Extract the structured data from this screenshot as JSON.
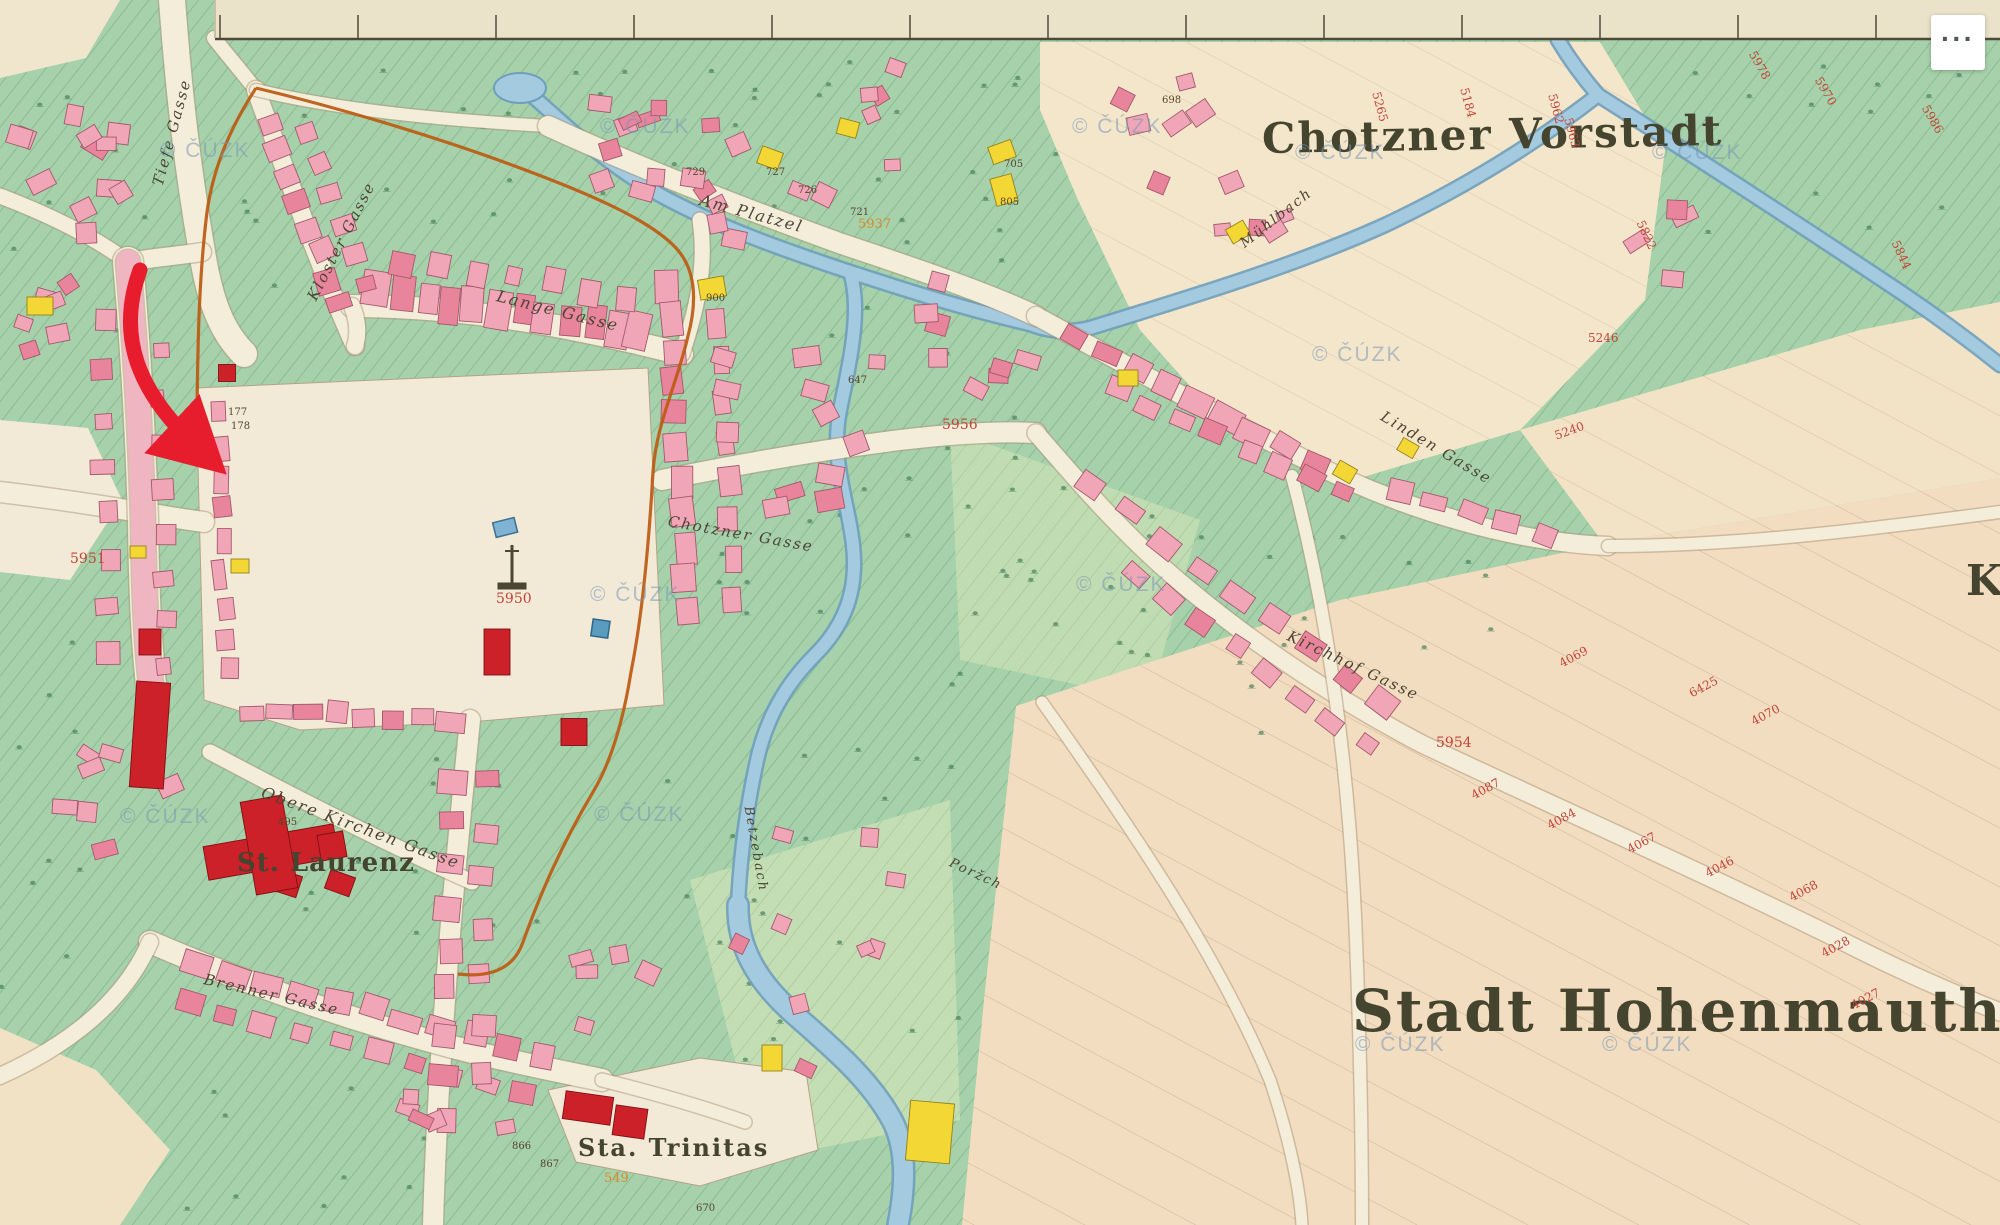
{
  "controls": {
    "more_button_label": "···"
  },
  "map": {
    "attribution_watermark": "© ČÚZK",
    "place_labels": [
      {
        "id": "chotzner-vorstadt",
        "text": "Chotzner Vorstadt",
        "x": 1262,
        "y": 118,
        "size": 42,
        "rot": -1,
        "spacing": 2
      },
      {
        "id": "stadt-hohenmauth",
        "text": "Stadt Hohenmauth",
        "x": 1352,
        "y": 982,
        "size": 58,
        "rot": 0,
        "spacing": 2
      },
      {
        "id": "st-laurenz",
        "text": "St. Laurenz",
        "x": 237,
        "y": 850,
        "size": 26,
        "rot": 0,
        "spacing": 1
      },
      {
        "id": "sta-trinitas",
        "text": "Sta. Trinitas",
        "x": 578,
        "y": 1136,
        "size": 24,
        "rot": 0,
        "spacing": 2
      },
      {
        "id": "k-cutoff",
        "text": "K",
        "x": 1966,
        "y": 560,
        "size": 42,
        "rot": 0,
        "spacing": 0
      }
    ],
    "street_labels": [
      {
        "text": "Tiefe Gasse",
        "x": 158,
        "y": 178,
        "rot": -75,
        "size": 15
      },
      {
        "text": "Kloster Gasse",
        "x": 312,
        "y": 292,
        "rot": -63,
        "size": 15
      },
      {
        "text": "Lange Gasse",
        "x": 497,
        "y": 288,
        "rot": 14,
        "size": 16
      },
      {
        "text": "Am Platzel",
        "x": 700,
        "y": 192,
        "rot": 15,
        "size": 16
      },
      {
        "text": "Chotzner Gasse",
        "x": 668,
        "y": 514,
        "rot": 10,
        "size": 15
      },
      {
        "text": "Linden Gasse",
        "x": 1382,
        "y": 408,
        "rot": 31,
        "size": 15
      },
      {
        "text": "Kirchhof Gasse",
        "x": 1288,
        "y": 628,
        "rot": 25,
        "size": 15
      },
      {
        "text": "Obere Kirchen Gasse",
        "x": 262,
        "y": 784,
        "rot": 20,
        "size": 16
      },
      {
        "text": "Brenner Gasse",
        "x": 204,
        "y": 972,
        "rot": 13,
        "size": 15
      },
      {
        "text": "Mühlbach",
        "x": 1242,
        "y": 238,
        "rot": -38,
        "size": 14
      },
      {
        "text": "Betzebach",
        "x": 748,
        "y": 800,
        "rot": 80,
        "size": 13
      },
      {
        "text": "Poržch",
        "x": 950,
        "y": 856,
        "rot": 25,
        "size": 13
      }
    ],
    "survey_numbers": [
      {
        "text": "5951",
        "x": 70,
        "y": 552,
        "rot": 0,
        "size": 14
      },
      {
        "text": "5950",
        "x": 496,
        "y": 592,
        "rot": 0,
        "size": 14
      },
      {
        "text": "5956",
        "x": 942,
        "y": 418,
        "rot": 0,
        "size": 14
      },
      {
        "text": "5937",
        "x": 858,
        "y": 218,
        "rot": 0,
        "size": 13,
        "color": "#d98a2b"
      },
      {
        "text": "5954",
        "x": 1436,
        "y": 736,
        "rot": 0,
        "size": 14
      },
      {
        "text": "5265",
        "x": 1376,
        "y": 86,
        "rot": 75,
        "size": 12
      },
      {
        "text": "5184",
        "x": 1464,
        "y": 82,
        "rot": 75,
        "size": 12
      },
      {
        "text": "5962",
        "x": 1552,
        "y": 88,
        "rot": 75,
        "size": 12
      },
      {
        "text": "5963",
        "x": 1568,
        "y": 112,
        "rot": 75,
        "size": 12
      },
      {
        "text": "5978",
        "x": 1752,
        "y": 46,
        "rot": 60,
        "size": 12
      },
      {
        "text": "5970",
        "x": 1818,
        "y": 72,
        "rot": 60,
        "size": 12
      },
      {
        "text": "5986",
        "x": 1925,
        "y": 100,
        "rot": 60,
        "size": 12
      },
      {
        "text": "5822",
        "x": 1640,
        "y": 215,
        "rot": 65,
        "size": 12
      },
      {
        "text": "5844",
        "x": 1895,
        "y": 235,
        "rot": 65,
        "size": 12
      },
      {
        "text": "5246",
        "x": 1588,
        "y": 332,
        "rot": 0,
        "size": 12
      },
      {
        "text": "5240",
        "x": 1555,
        "y": 430,
        "rot": -20,
        "size": 12
      },
      {
        "text": "4069",
        "x": 1560,
        "y": 658,
        "rot": -28,
        "size": 12
      },
      {
        "text": "6425",
        "x": 1690,
        "y": 688,
        "rot": -28,
        "size": 12
      },
      {
        "text": "4070",
        "x": 1752,
        "y": 716,
        "rot": -28,
        "size": 12
      },
      {
        "text": "4087",
        "x": 1472,
        "y": 790,
        "rot": -28,
        "size": 12
      },
      {
        "text": "4084",
        "x": 1548,
        "y": 820,
        "rot": -28,
        "size": 12
      },
      {
        "text": "4067",
        "x": 1628,
        "y": 844,
        "rot": -28,
        "size": 12
      },
      {
        "text": "4046",
        "x": 1706,
        "y": 868,
        "rot": -28,
        "size": 12
      },
      {
        "text": "4068",
        "x": 1790,
        "y": 892,
        "rot": -28,
        "size": 12
      },
      {
        "text": "4028",
        "x": 1822,
        "y": 948,
        "rot": -28,
        "size": 12
      },
      {
        "text": "4027",
        "x": 1852,
        "y": 1000,
        "rot": -28,
        "size": 12
      },
      {
        "text": "549",
        "x": 604,
        "y": 1172,
        "rot": 0,
        "size": 13,
        "color": "#d98a2b"
      }
    ],
    "house_numbers": [
      {
        "text": "727",
        "x": 766,
        "y": 168
      },
      {
        "text": "726",
        "x": 798,
        "y": 186
      },
      {
        "text": "721",
        "x": 850,
        "y": 208
      },
      {
        "text": "729",
        "x": 686,
        "y": 168
      },
      {
        "text": "705",
        "x": 1004,
        "y": 160
      },
      {
        "text": "805",
        "x": 1000,
        "y": 198
      },
      {
        "text": "698",
        "x": 1162,
        "y": 96
      },
      {
        "text": "900",
        "x": 706,
        "y": 294
      },
      {
        "text": "647",
        "x": 848,
        "y": 376
      },
      {
        "text": "495",
        "x": 278,
        "y": 818
      },
      {
        "text": "866",
        "x": 512,
        "y": 1142
      },
      {
        "text": "867",
        "x": 540,
        "y": 1160
      },
      {
        "text": "670",
        "x": 696,
        "y": 1204
      },
      {
        "text": "177",
        "x": 228,
        "y": 408
      },
      {
        "text": "178",
        "x": 231,
        "y": 422
      }
    ],
    "watermarks": [
      {
        "x": 160,
        "y": 140
      },
      {
        "x": 600,
        "y": 116
      },
      {
        "x": 1072,
        "y": 116
      },
      {
        "x": 1295,
        "y": 142
      },
      {
        "x": 1652,
        "y": 142
      },
      {
        "x": 1312,
        "y": 344
      },
      {
        "x": 1076,
        "y": 574
      },
      {
        "x": 590,
        "y": 584
      },
      {
        "x": 594,
        "y": 804
      },
      {
        "x": 120,
        "y": 806
      },
      {
        "x": 1355,
        "y": 1034
      },
      {
        "x": 1602,
        "y": 1034
      }
    ]
  },
  "annotation": {
    "arrow": {
      "color": "#e71d2d",
      "tail": {
        "x": 140,
        "y": 270
      },
      "c1": {
        "x": 116,
        "y": 336
      },
      "c2": {
        "x": 138,
        "y": 392
      },
      "tip": {
        "x": 196,
        "y": 446
      }
    }
  }
}
